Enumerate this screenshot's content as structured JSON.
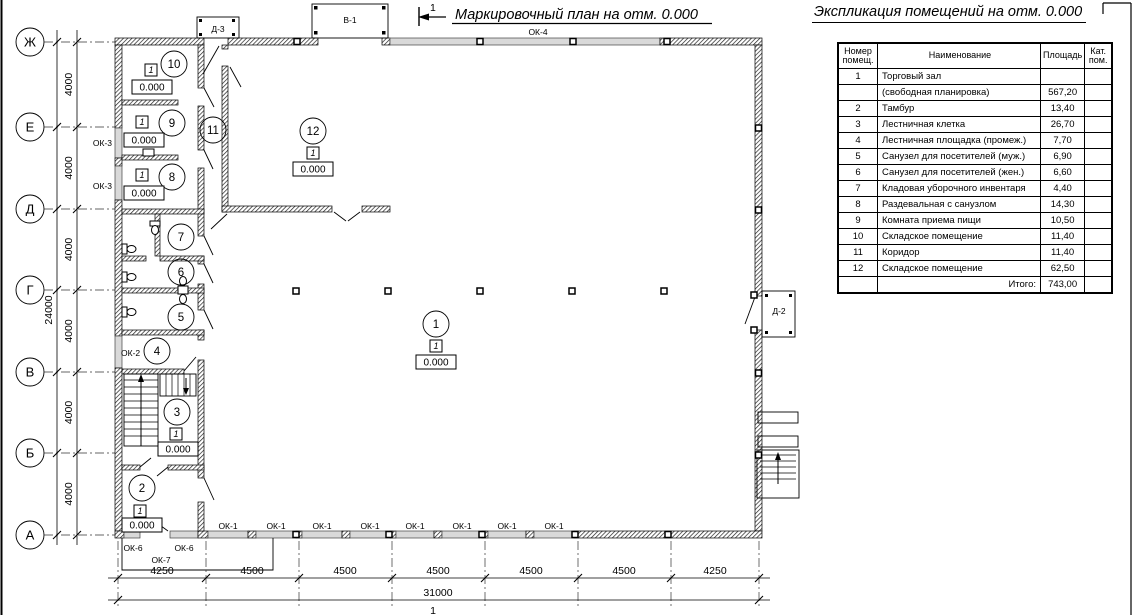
{
  "plan": {
    "title": "Маркировочный план на отм. 0.000",
    "section_mark": "1",
    "axis_rows": [
      "Ж",
      "Е",
      "Д",
      "Г",
      "В",
      "Б",
      "А"
    ],
    "dim_row_spacing": "4000",
    "dim_row_total": "24000",
    "dim_col_segments": [
      "4250",
      "4500",
      "4500",
      "4500",
      "4500",
      "4500",
      "4250"
    ],
    "dim_col_total": "31000",
    "axis_col_mark": "1",
    "storey_mark": "1",
    "level_mark": "0.000",
    "room_numbers": [
      "1",
      "2",
      "3",
      "4",
      "5",
      "6",
      "7",
      "8",
      "9",
      "10",
      "11",
      "12"
    ],
    "openings": {
      "d1": "Д-1",
      "d2": "Д-2",
      "d3": "Д-3",
      "v1": "В-1",
      "ok1": "ОК-1",
      "ok2": "ОК-2",
      "ok3": "ОК-3",
      "ok4": "ОК-4",
      "ok6": "ОК-6",
      "ok7": "ОК-7"
    }
  },
  "schedule": {
    "title": "Экспликация помещений на отм. 0.000",
    "headers": {
      "num": "Номер помещ.",
      "name": "Наименование",
      "area": "Площадь",
      "cat": "Кат. пом."
    },
    "rows": [
      {
        "num": "1",
        "name": "Торговый зал",
        "area": "",
        "cat": ""
      },
      {
        "num": "",
        "name": "(свободная планировка)",
        "area": "567,20",
        "cat": ""
      },
      {
        "num": "2",
        "name": "Тамбур",
        "area": "13,40",
        "cat": ""
      },
      {
        "num": "3",
        "name": "Лестничная клетка",
        "area": "26,70",
        "cat": ""
      },
      {
        "num": "4",
        "name": "Лестничная площадка (промеж.)",
        "area": "7,70",
        "cat": ""
      },
      {
        "num": "5",
        "name": "Санузел для посетителей (муж.)",
        "area": "6,90",
        "cat": ""
      },
      {
        "num": "6",
        "name": "Санузел для посетителей (жен.)",
        "area": "6,60",
        "cat": ""
      },
      {
        "num": "7",
        "name": "Кладовая уборочного инвентаря",
        "area": "4,40",
        "cat": ""
      },
      {
        "num": "8",
        "name": "Раздевальная с санузлом",
        "area": "14,30",
        "cat": ""
      },
      {
        "num": "9",
        "name": "Комната приема пищи",
        "area": "10,50",
        "cat": ""
      },
      {
        "num": "10",
        "name": "Складское помещение",
        "area": "11,40",
        "cat": ""
      },
      {
        "num": "11",
        "name": "Коридор",
        "area": "11,40",
        "cat": ""
      },
      {
        "num": "12",
        "name": "Складское помещение",
        "area": "62,50",
        "cat": ""
      }
    ],
    "total_label": "Итого:",
    "total_value": "743,00"
  }
}
